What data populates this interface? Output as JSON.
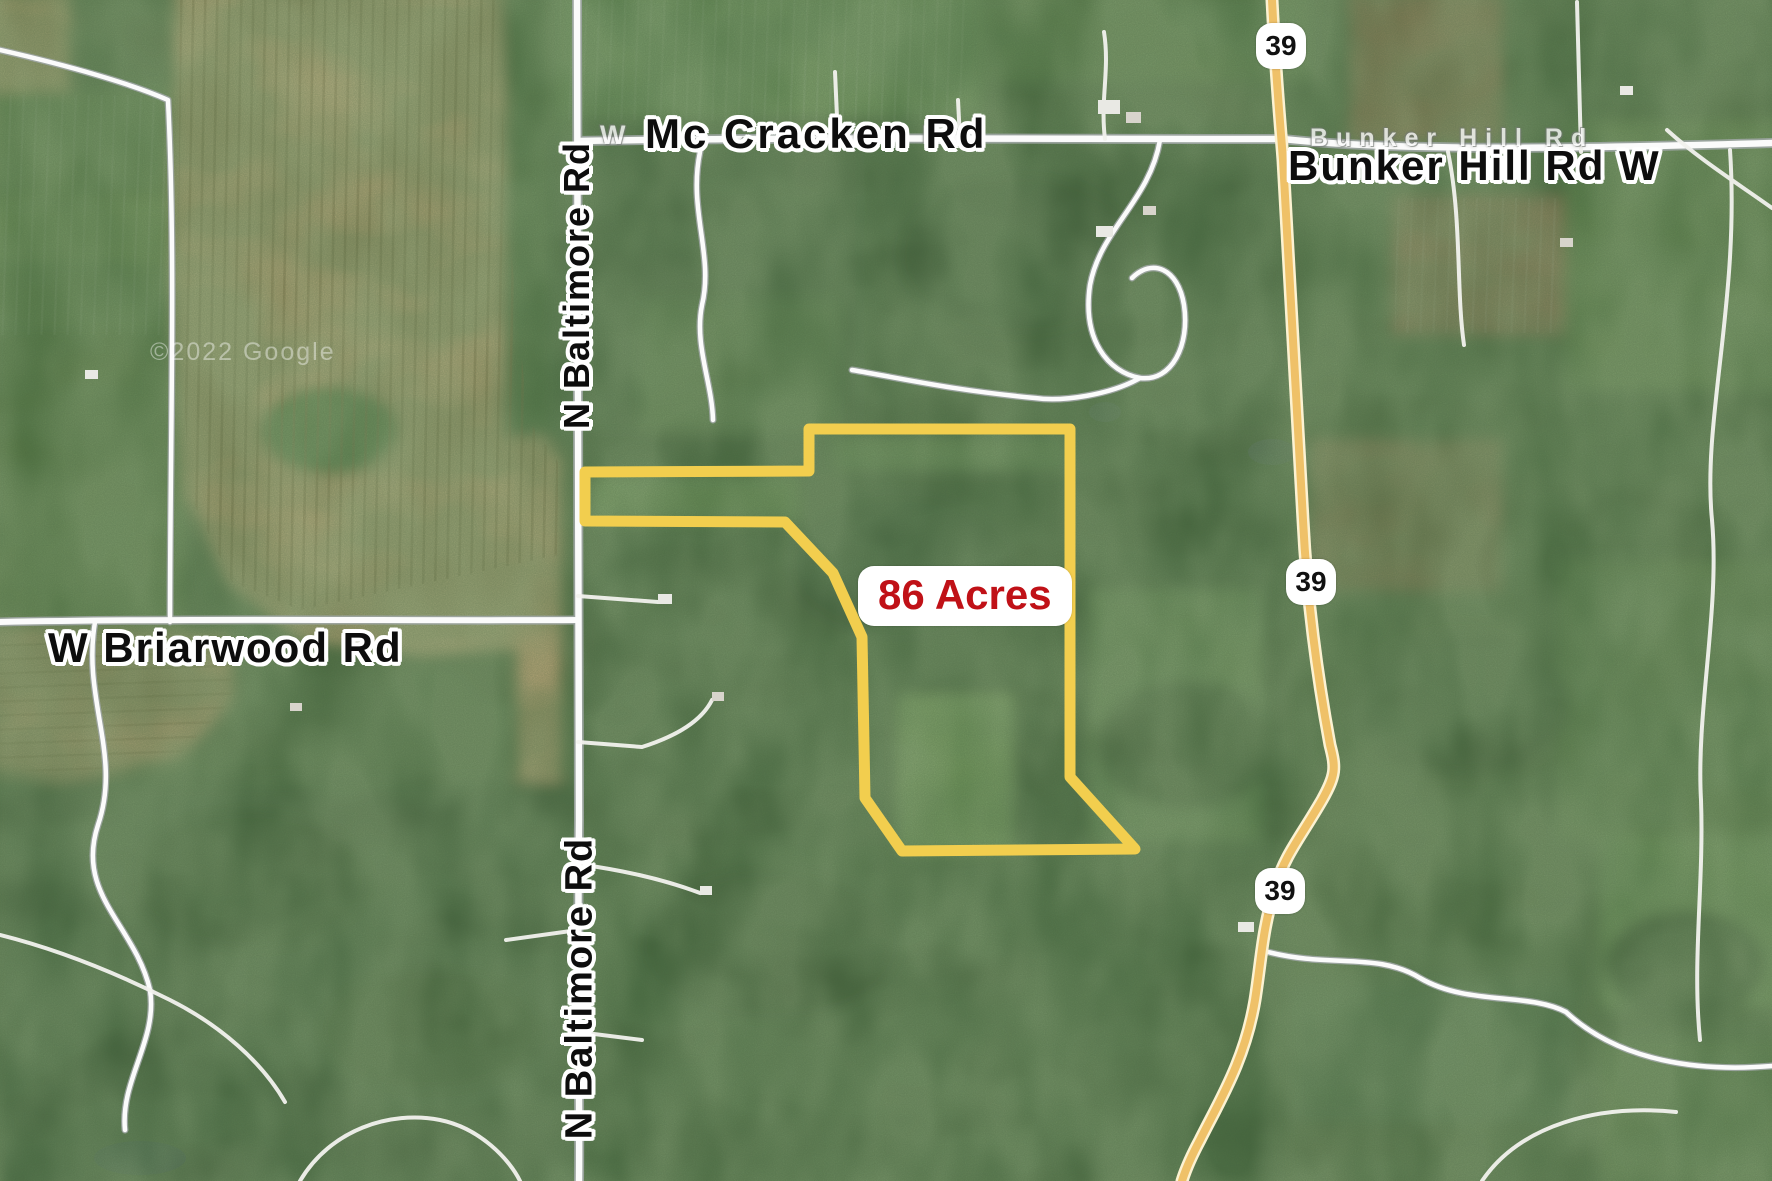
{
  "map": {
    "description": "Satellite aerial map with property boundary overlay",
    "attribution": "©2022 Google",
    "acreage_label": {
      "text": "86 Acres"
    },
    "boundary": {
      "points": "585,472 809,471 809,429 1070,429 1070,777 1135,849 902,851 865,798 862,637 833,573 785,522 585,521",
      "color": "#f2ce4e"
    },
    "road_labels": {
      "mccracken": "Mc Cracken Rd",
      "mccracken_underlying": "W Mc Cracken Rd",
      "bunker_hill": "Bunker Hill Rd W",
      "bunker_hill_underlying": "Bunker Hill Rd",
      "baltimore_top": "N Baltimore Rd",
      "baltimore_bottom": "N Baltimore Rd",
      "briarwood": "W Briarwood Rd"
    },
    "route_shields": [
      {
        "label": "39"
      },
      {
        "label": "39"
      },
      {
        "label": "39"
      }
    ],
    "colors": {
      "boundary": "#f2ce4e",
      "acreage_text": "#c01117",
      "acreage_bg": "#ffffff",
      "state_route": "#efc168",
      "local_road": "#fbfbfb",
      "label_text": "#0d0d0d",
      "label_halo": "#ffffff"
    }
  }
}
